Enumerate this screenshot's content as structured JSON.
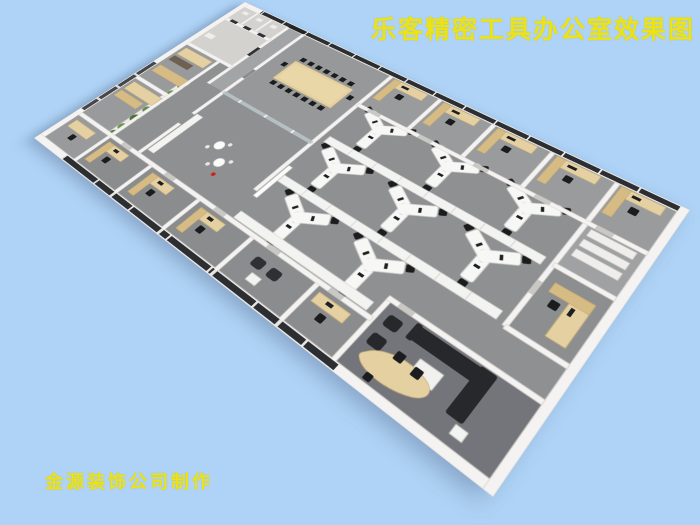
{
  "title": {
    "text": "乐客精密工具办公室效果图"
  },
  "credit": {
    "text": "金源装饰公司制作"
  },
  "palette": {
    "background": "#aed3f6",
    "text_yellow": "#ece312",
    "floor": "#8f9092",
    "floor_dark": "#74757a",
    "wall": "#f4f3f1",
    "wall_edge": "#d8d6d2",
    "glass_dark": "#2c2e31",
    "wood": "#e4d0a1",
    "wood_dark": "#d6bc84",
    "furniture_black": "#1b1c1e",
    "cabinet_white": "#f3f3f1",
    "sofa_black": "#27282b",
    "accent_red": "#c8241f",
    "plant_green": "#55803f"
  },
  "scene": {
    "view": "isometric 3D rendering of an office floor plan on light blue background",
    "open_office_workstation_clusters": 8,
    "conference_room_seats": 16,
    "window_offices_along_facade": 5,
    "offices_along_bottom_wall": 5,
    "executive_office": "sofa set, coffee table, curved wood desk",
    "plant_row_plants": 7,
    "break_area_round_tables": 2,
    "washroom_stalls": 3
  }
}
